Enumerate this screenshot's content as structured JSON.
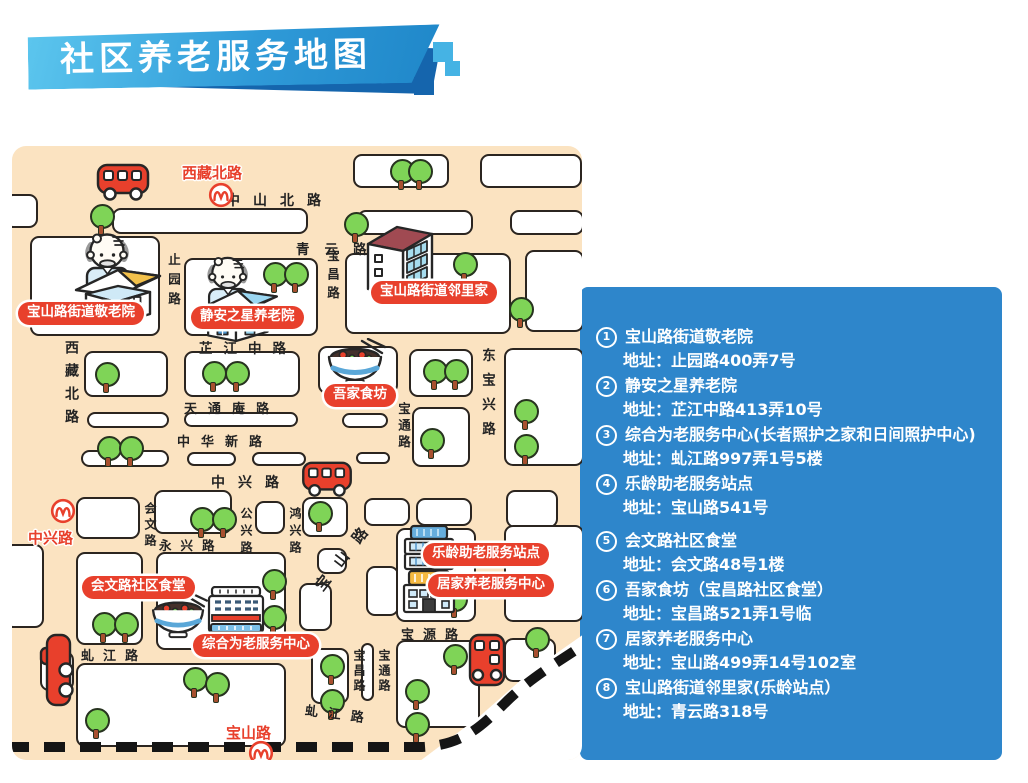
{
  "title": "社区养老服务地图",
  "colors": {
    "panel_blue": "#2e86cb",
    "map_background": "#fbe3c1",
    "label_red": "#e8402c",
    "banner_light_blue": "#45b3e4",
    "banner_dark_blue": "#1565ad",
    "tree_green": "#7fd457"
  },
  "map": {
    "streets": {
      "zhongshan_north": "中山北路",
      "qingyun": "青云路",
      "zhijiang_middle": "芷江中路",
      "tiantongan": "天通庵路",
      "zhonghua_new": "中华新路",
      "zhongxing": "中兴路",
      "yongxing": "永兴路",
      "qiujiang_left": "虬江路",
      "qiujiang_bottom": "虬江路",
      "baoyuan": "宝源路",
      "xizang_north": "西藏北路",
      "zhiyuan": "止园路",
      "baochang_top": "宝昌路",
      "baochang_bottom": "宝昌路",
      "baotong_mid": "宝通路",
      "baotong_bottom": "宝通路",
      "huiwen": "会文路",
      "gongxing": "公兴路",
      "hongxing": "鸿兴路",
      "dongbaoxing": "东宝兴路",
      "baoshan_diagonal": "宝山路"
    },
    "stations": {
      "xizangbeilu": "西藏北路",
      "zhongxinglu": "中兴路",
      "baoshanlu": "宝山路"
    },
    "pois": {
      "jinglaoyuan": "宝山路街道敬老院",
      "jingan_star": "静安之星养老院",
      "linlijia": "宝山路街道邻里家",
      "wujia_shifang": "吾家食坊",
      "huiwen_canteen": "会文路社区食堂",
      "zonghe_center": "综合为老服务中心",
      "leling_station": "乐龄助老服务站点",
      "jujia_center": "居家养老服务中心"
    }
  },
  "panel": {
    "items": [
      {
        "num": "1",
        "name": "宝山路街道敬老院",
        "addr": "地址：止园路400弄7号"
      },
      {
        "num": "2",
        "name": "静安之星养老院",
        "addr": "地址：芷江中路413弄10号"
      },
      {
        "num": "3",
        "name": "综合为老服务中心(长者照护之家和日间照护中心)",
        "addr": "地址：虬江路997弄1号5楼"
      },
      {
        "num": "4",
        "name": "乐龄助老服务站点",
        "addr": "地址：宝山路541号"
      },
      {
        "num": "5",
        "name": "会文路社区食堂",
        "addr": "地址：会文路48号1楼"
      },
      {
        "num": "6",
        "name": "吾家食坊（宝昌路社区食堂）",
        "addr": "地址：宝昌路521弄1号临"
      },
      {
        "num": "7",
        "name": "居家养老服务中心",
        "addr": "地址：宝山路499弄14号102室"
      },
      {
        "num": "8",
        "name": "宝山路街道邻里家(乐龄站点）",
        "addr": "地址：青云路318号"
      }
    ]
  }
}
